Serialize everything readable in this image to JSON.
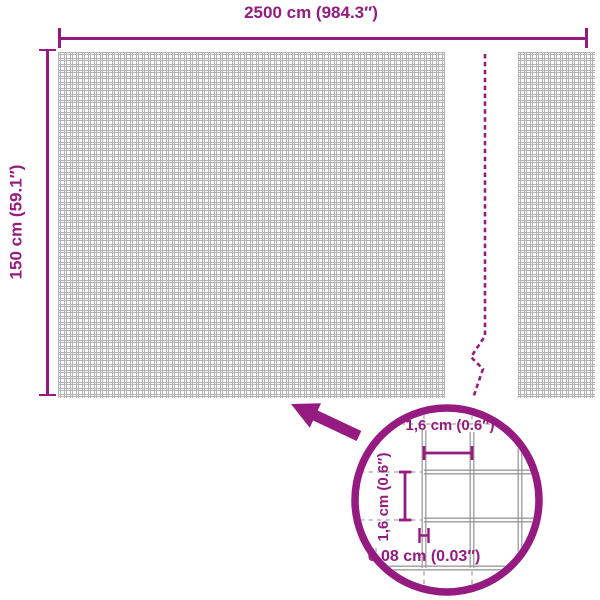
{
  "diagram": {
    "type": "product-dimension-diagram",
    "colors": {
      "accent": "#951b81",
      "mesh_line": "#b4b4b4",
      "detail_wire": "#9b9b9b",
      "background": "#ffffff"
    },
    "dimensions": {
      "width": {
        "label": "2500 cm (984.3″)"
      },
      "height": {
        "label": "150 cm (59.1″)"
      }
    },
    "detail": {
      "mesh_width": {
        "label": "1,6 cm (0.6″)"
      },
      "mesh_height": {
        "label": "1,6 cm (0.6″)"
      },
      "wire_thickness": {
        "label": "0,08 cm (0.03″)"
      }
    },
    "icons": {
      "arrow": "zoom-callout-arrow-icon",
      "circle": "magnifier-detail-circle",
      "break_line": "panel-break-dashed-line"
    }
  }
}
